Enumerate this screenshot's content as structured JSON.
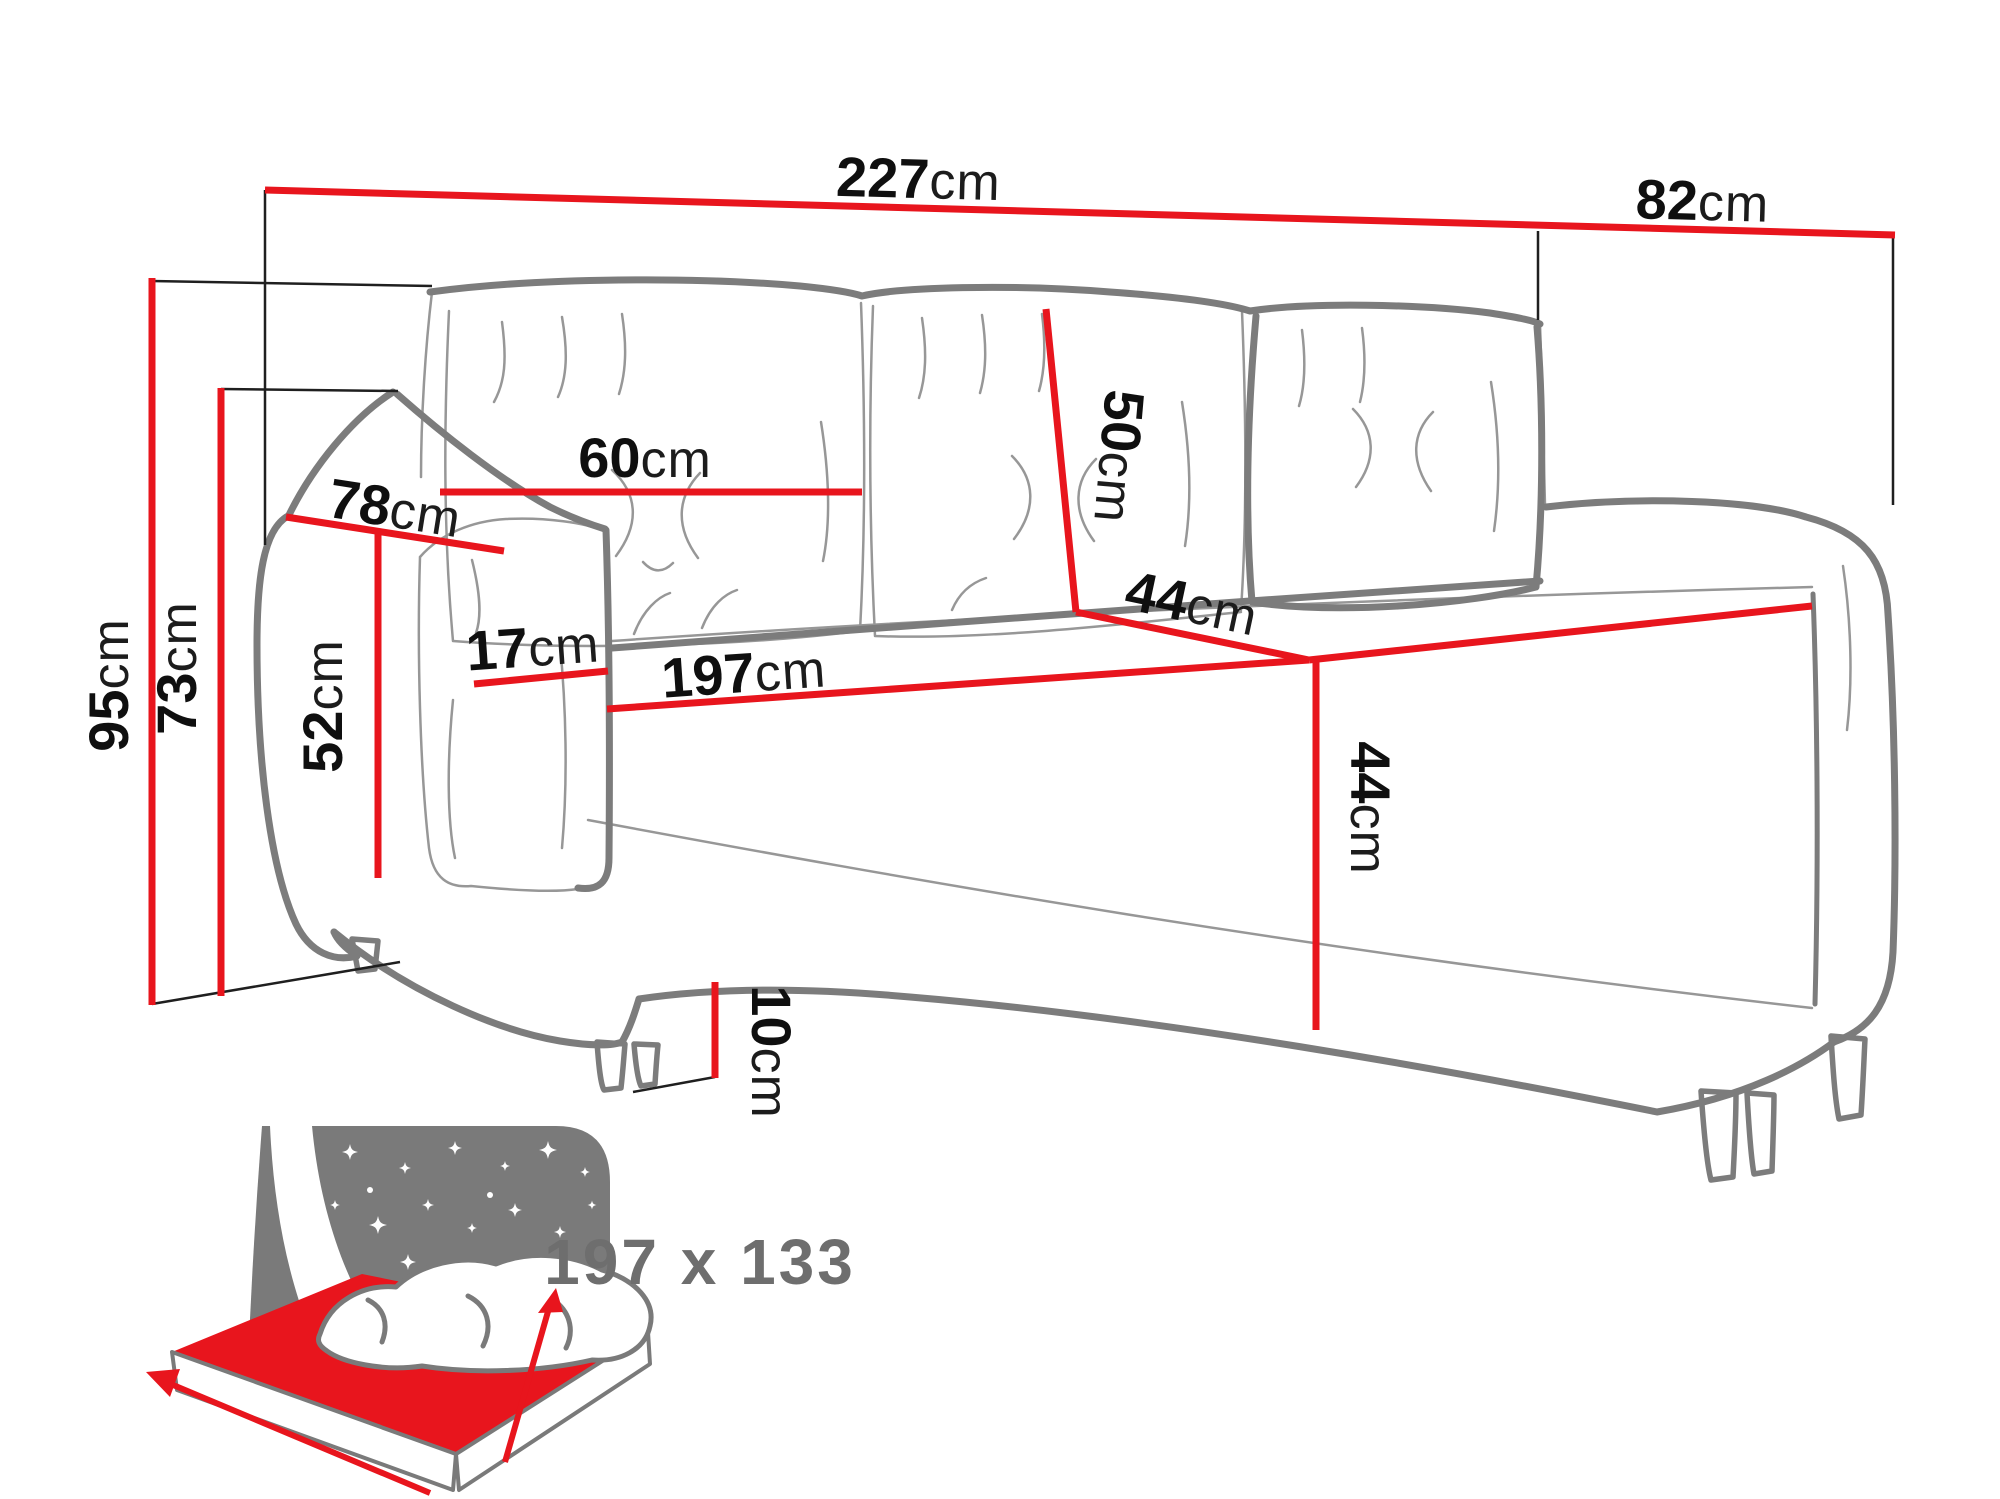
{
  "diagram": {
    "type": "sofa-dimension-diagram",
    "unit": "cm",
    "labels": {
      "total_width": {
        "value": "227",
        "unit": "cm"
      },
      "total_depth": {
        "value": "82",
        "unit": "cm"
      },
      "back_cushion_width": {
        "value": "60",
        "unit": "cm"
      },
      "back_cushion_height": {
        "value": "50",
        "unit": "cm"
      },
      "armrest_depth": {
        "value": "78",
        "unit": "cm"
      },
      "armrest_width": {
        "value": "17",
        "unit": "cm"
      },
      "seat_width": {
        "value": "197",
        "unit": "cm"
      },
      "seat_depth": {
        "value": "44",
        "unit": "cm"
      },
      "seat_height": {
        "value": "44",
        "unit": "cm"
      },
      "armrest_height": {
        "value": "52",
        "unit": "cm"
      },
      "total_height": {
        "value": "95",
        "unit": "cm"
      },
      "back_height": {
        "value": "73",
        "unit": "cm"
      },
      "leg_height": {
        "value": "10",
        "unit": "cm"
      }
    },
    "sleeping_area": {
      "value": "197 x 133"
    },
    "colors": {
      "dimension_red": "#e8151d",
      "sofa_outline_gray": "#7c7c7c",
      "sofa_detail_gray": "#979797",
      "label_black": "#0f0f0f",
      "icon_gray": "#7a7a7a",
      "icon_text_gray": "#6e6e6e",
      "background": "#ffffff"
    }
  }
}
